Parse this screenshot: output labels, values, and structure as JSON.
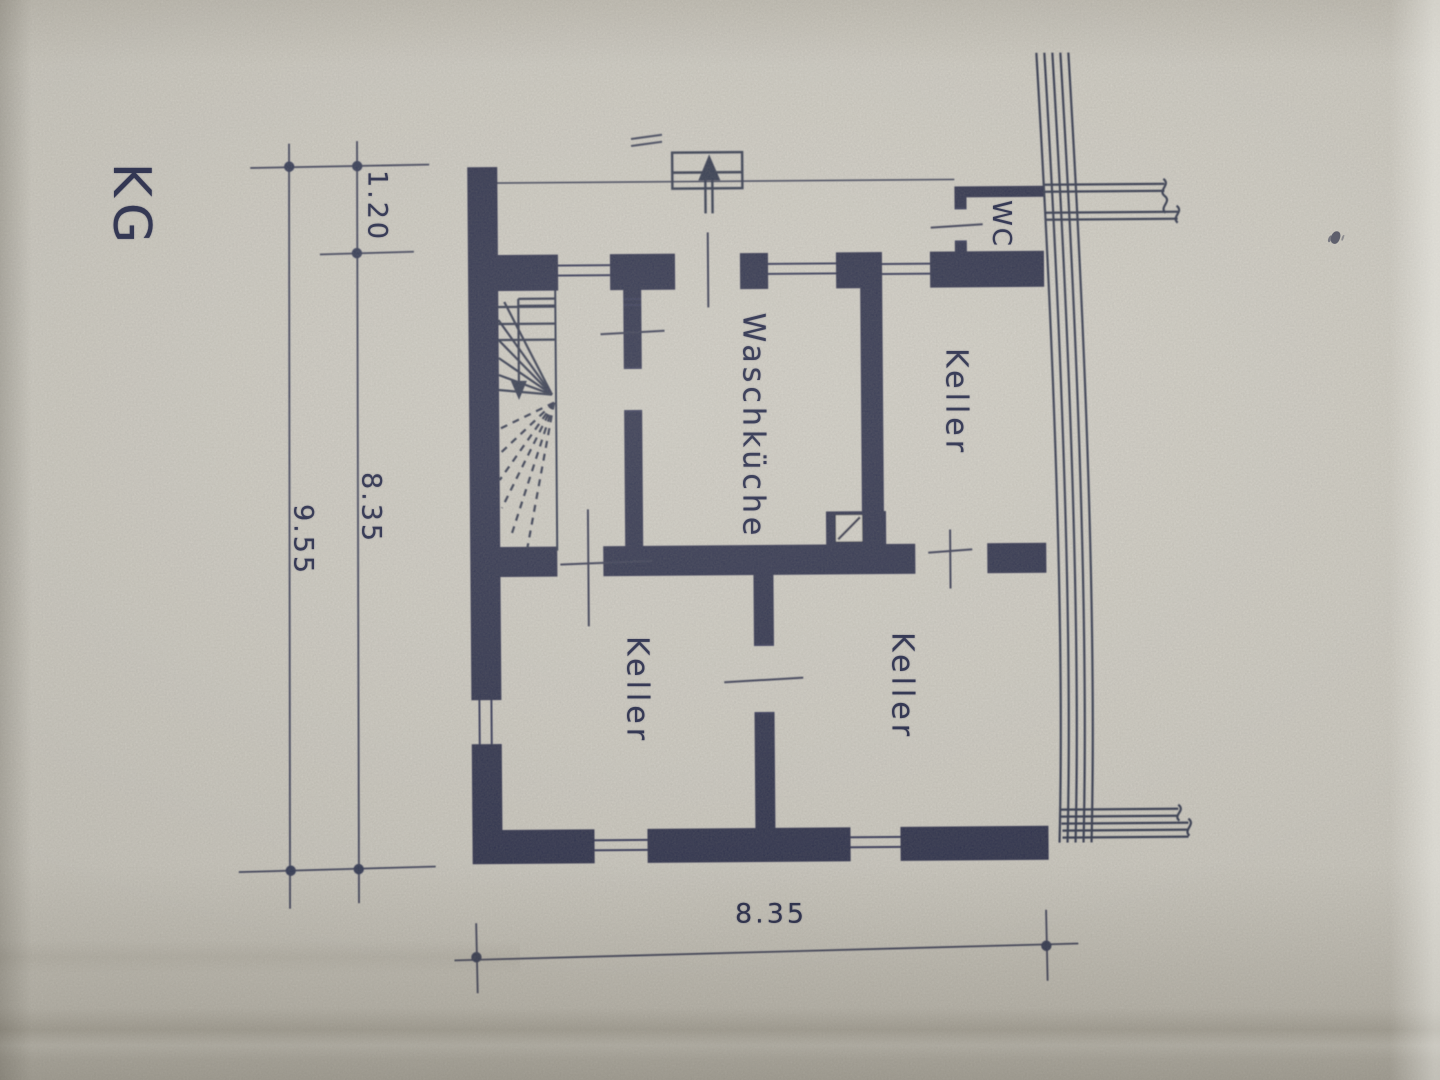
{
  "photo": {
    "paper_color": "#d3d0c7",
    "ink_color": "#2a2e49"
  },
  "plan": {
    "floor_label": "KG",
    "rooms": [
      {
        "name": "WC"
      },
      {
        "name": "Keller"
      },
      {
        "name": "Waschküche"
      },
      {
        "name": "Keller"
      },
      {
        "name": "Keller"
      }
    ],
    "dimensions": {
      "upper_left": "1.20",
      "left_inner": "8.35",
      "left_overall": "9.55",
      "bottom": "8.35"
    }
  }
}
